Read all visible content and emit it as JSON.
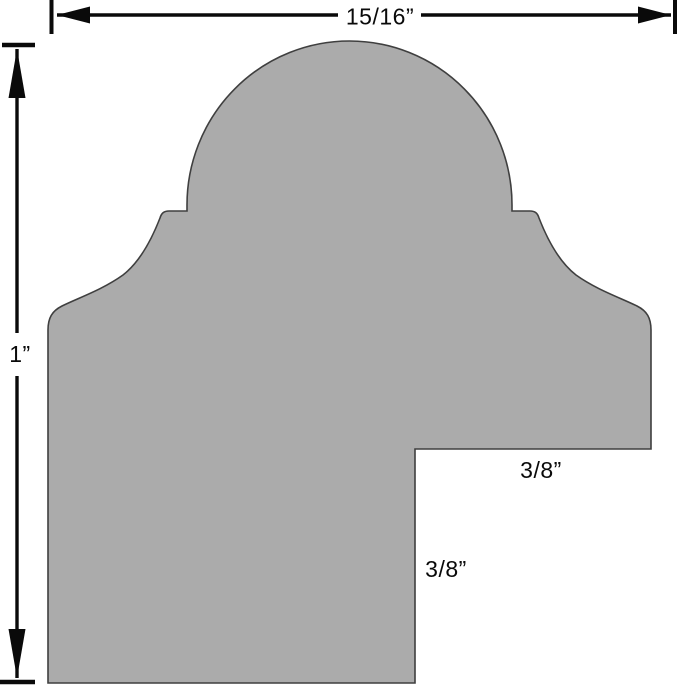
{
  "diagram": {
    "labels": {
      "overall_width": "15/16”",
      "overall_height": "1”",
      "rabbet_width": "3/8”",
      "rabbet_depth": "3/8”"
    },
    "colors": {
      "background": "#ffffff",
      "profile_fill": "#ababab",
      "profile_outline": "#3f3f3f",
      "dimension_ink": "#0a0a0a"
    }
  }
}
